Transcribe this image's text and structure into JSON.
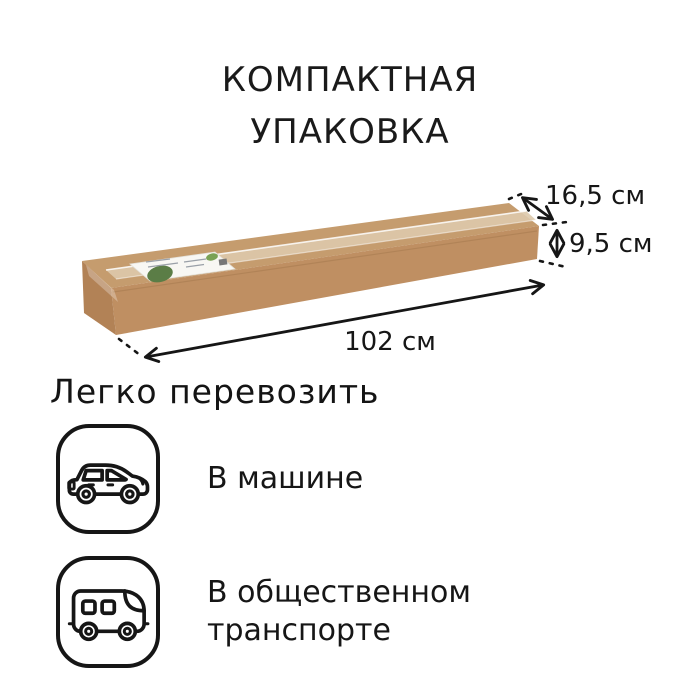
{
  "colors": {
    "background": "#ffffff",
    "text": "#161616",
    "box_top": "#c59c6e",
    "box_front": "#bf8f62",
    "box_end": "#b28256",
    "tape": "#ddc9ab",
    "label_bg": "#f8f7f3",
    "leaf_green": "#5b7d46"
  },
  "title": {
    "line1": "КОМПАКТНАЯ",
    "line2": "УПАКОВКА"
  },
  "package": {
    "kind": "cardboard-box",
    "label_graphic": "green-leaf-shipping-label",
    "dimensions": {
      "depth": "16,5 см",
      "height": "9,5 см",
      "length": "102 см"
    }
  },
  "transport": {
    "heading": "Легко перевозить",
    "items": [
      {
        "icon": "car-icon",
        "label": "В машине"
      },
      {
        "icon": "bus-icon",
        "label": "В общественном транспорте"
      }
    ]
  }
}
